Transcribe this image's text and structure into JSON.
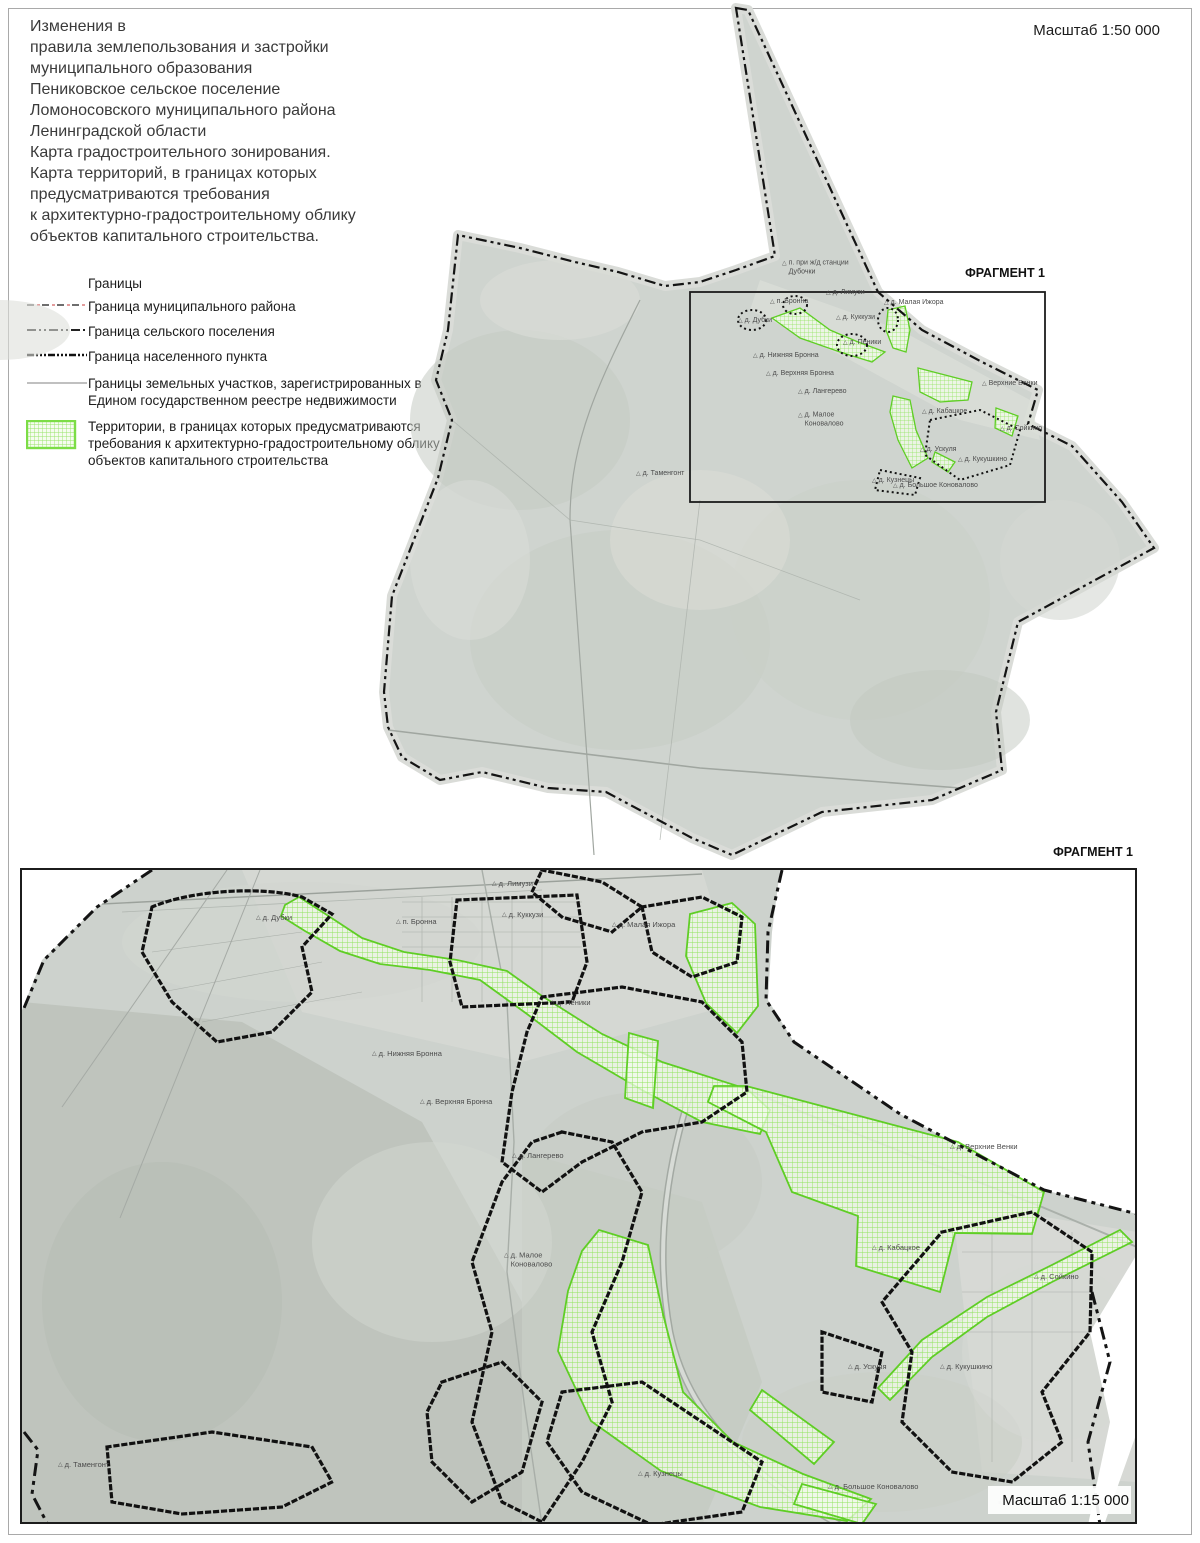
{
  "document": {
    "title_lines": "Изменения в\nправила землепользования и застройки\nмуниципального образования\nПениковское сельское поселение\nЛомоносовского муниципального района\nЛенинградской области\nКарта градостроительного зонирования.\nКарта территорий, в границах которых\nпредусматриваются требования\nк архитектурно-градостроительному облику\nобъектов капитального строительства.",
    "overview_scale": "Масштаб 1:50 000",
    "fragment_scale": "Масштаб 1:15 000",
    "fragment_callout": "ФРАГМЕНТ 1",
    "fragment_title": "ФРАГМЕНТ 1",
    "attribution": "Source: Esri, Maxar, Earthstar Geographics"
  },
  "legend": {
    "header": "Границы",
    "items": [
      {
        "id": "municipal-district",
        "label": "Граница муниципального района"
      },
      {
        "id": "rural-settlement",
        "label": "Граница сельского поселения"
      },
      {
        "id": "locality",
        "label": "Граница населенного пункта"
      },
      {
        "id": "parcels",
        "label": "Границы земельных участков, зарегистрированных в Едином государственном реестре недвижимости"
      },
      {
        "id": "territories",
        "label": "Территории, в границах которых предусматриваются требования к архитектурно-градостроительному облику объектов капитального строительства"
      }
    ]
  },
  "colors": {
    "territory_green": "#5fce25",
    "hatch_fill": "#f2fbea",
    "boundary_black": "#141414",
    "municipal_pink": "#e39c9c",
    "map_gray": "#cfd4cf"
  },
  "maps": {
    "overview": {
      "labels": [
        {
          "text": "п. при ж/д станции\nДубочки",
          "x": 782,
          "y": 268
        },
        {
          "text": "д. Лимузи",
          "x": 826,
          "y": 293
        },
        {
          "text": "п. Бронна",
          "x": 770,
          "y": 302
        },
        {
          "text": "д. Малая Ижора",
          "x": 884,
          "y": 303
        },
        {
          "text": "д. Дубки",
          "x": 738,
          "y": 321
        },
        {
          "text": "д. Куккузи",
          "x": 836,
          "y": 318
        },
        {
          "text": "д. Пеники",
          "x": 843,
          "y": 343
        },
        {
          "text": "д. Нижняя Бронна",
          "x": 753,
          "y": 356
        },
        {
          "text": "д. Верхняя Бронна",
          "x": 766,
          "y": 374
        },
        {
          "text": "д. Лангерево",
          "x": 798,
          "y": 392
        },
        {
          "text": "д. Малое\nКоновалово",
          "x": 798,
          "y": 420
        },
        {
          "text": "Верхние Венки",
          "x": 982,
          "y": 384
        },
        {
          "text": "д. Кабацкое",
          "x": 922,
          "y": 412
        },
        {
          "text": "д. Сойкино",
          "x": 1000,
          "y": 429
        },
        {
          "text": "д. Ускуля",
          "x": 920,
          "y": 450
        },
        {
          "text": "д. Кукушкино",
          "x": 958,
          "y": 460
        },
        {
          "text": "д. Кузнецы",
          "x": 872,
          "y": 481
        },
        {
          "text": "д. Большое Коновалово",
          "x": 893,
          "y": 486
        },
        {
          "text": "д. Таменгонт",
          "x": 636,
          "y": 474
        }
      ]
    },
    "fragment": {
      "labels": [
        {
          "text": "д. Лимузи",
          "x": 492,
          "y": 884
        },
        {
          "text": "д. Дубки",
          "x": 256,
          "y": 918
        },
        {
          "text": "п. Бронна",
          "x": 396,
          "y": 922
        },
        {
          "text": "д. Куккузи",
          "x": 502,
          "y": 915
        },
        {
          "text": "д. Малая Ижора",
          "x": 612,
          "y": 925
        },
        {
          "text": "д. Пеники",
          "x": 550,
          "y": 1003
        },
        {
          "text": "д. Нижняя Бронна",
          "x": 372,
          "y": 1054
        },
        {
          "text": "д. Верхняя Бронна",
          "x": 420,
          "y": 1102
        },
        {
          "text": "д. Лангерево",
          "x": 512,
          "y": 1156
        },
        {
          "text": "д. Малое\nКоновалово",
          "x": 504,
          "y": 1260
        },
        {
          "text": "д. Верхние Венки",
          "x": 950,
          "y": 1147
        },
        {
          "text": "д. Кабацкое",
          "x": 872,
          "y": 1248
        },
        {
          "text": "д. Сойкино",
          "x": 1034,
          "y": 1277
        },
        {
          "text": "д. Ускуля",
          "x": 848,
          "y": 1367
        },
        {
          "text": "д. Кукушкино",
          "x": 940,
          "y": 1367
        },
        {
          "text": "д. Таменгонт",
          "x": 58,
          "y": 1465
        },
        {
          "text": "д. Кузнецы",
          "x": 638,
          "y": 1474
        },
        {
          "text": "д. Большое Коновалово",
          "x": 828,
          "y": 1487
        }
      ]
    }
  }
}
